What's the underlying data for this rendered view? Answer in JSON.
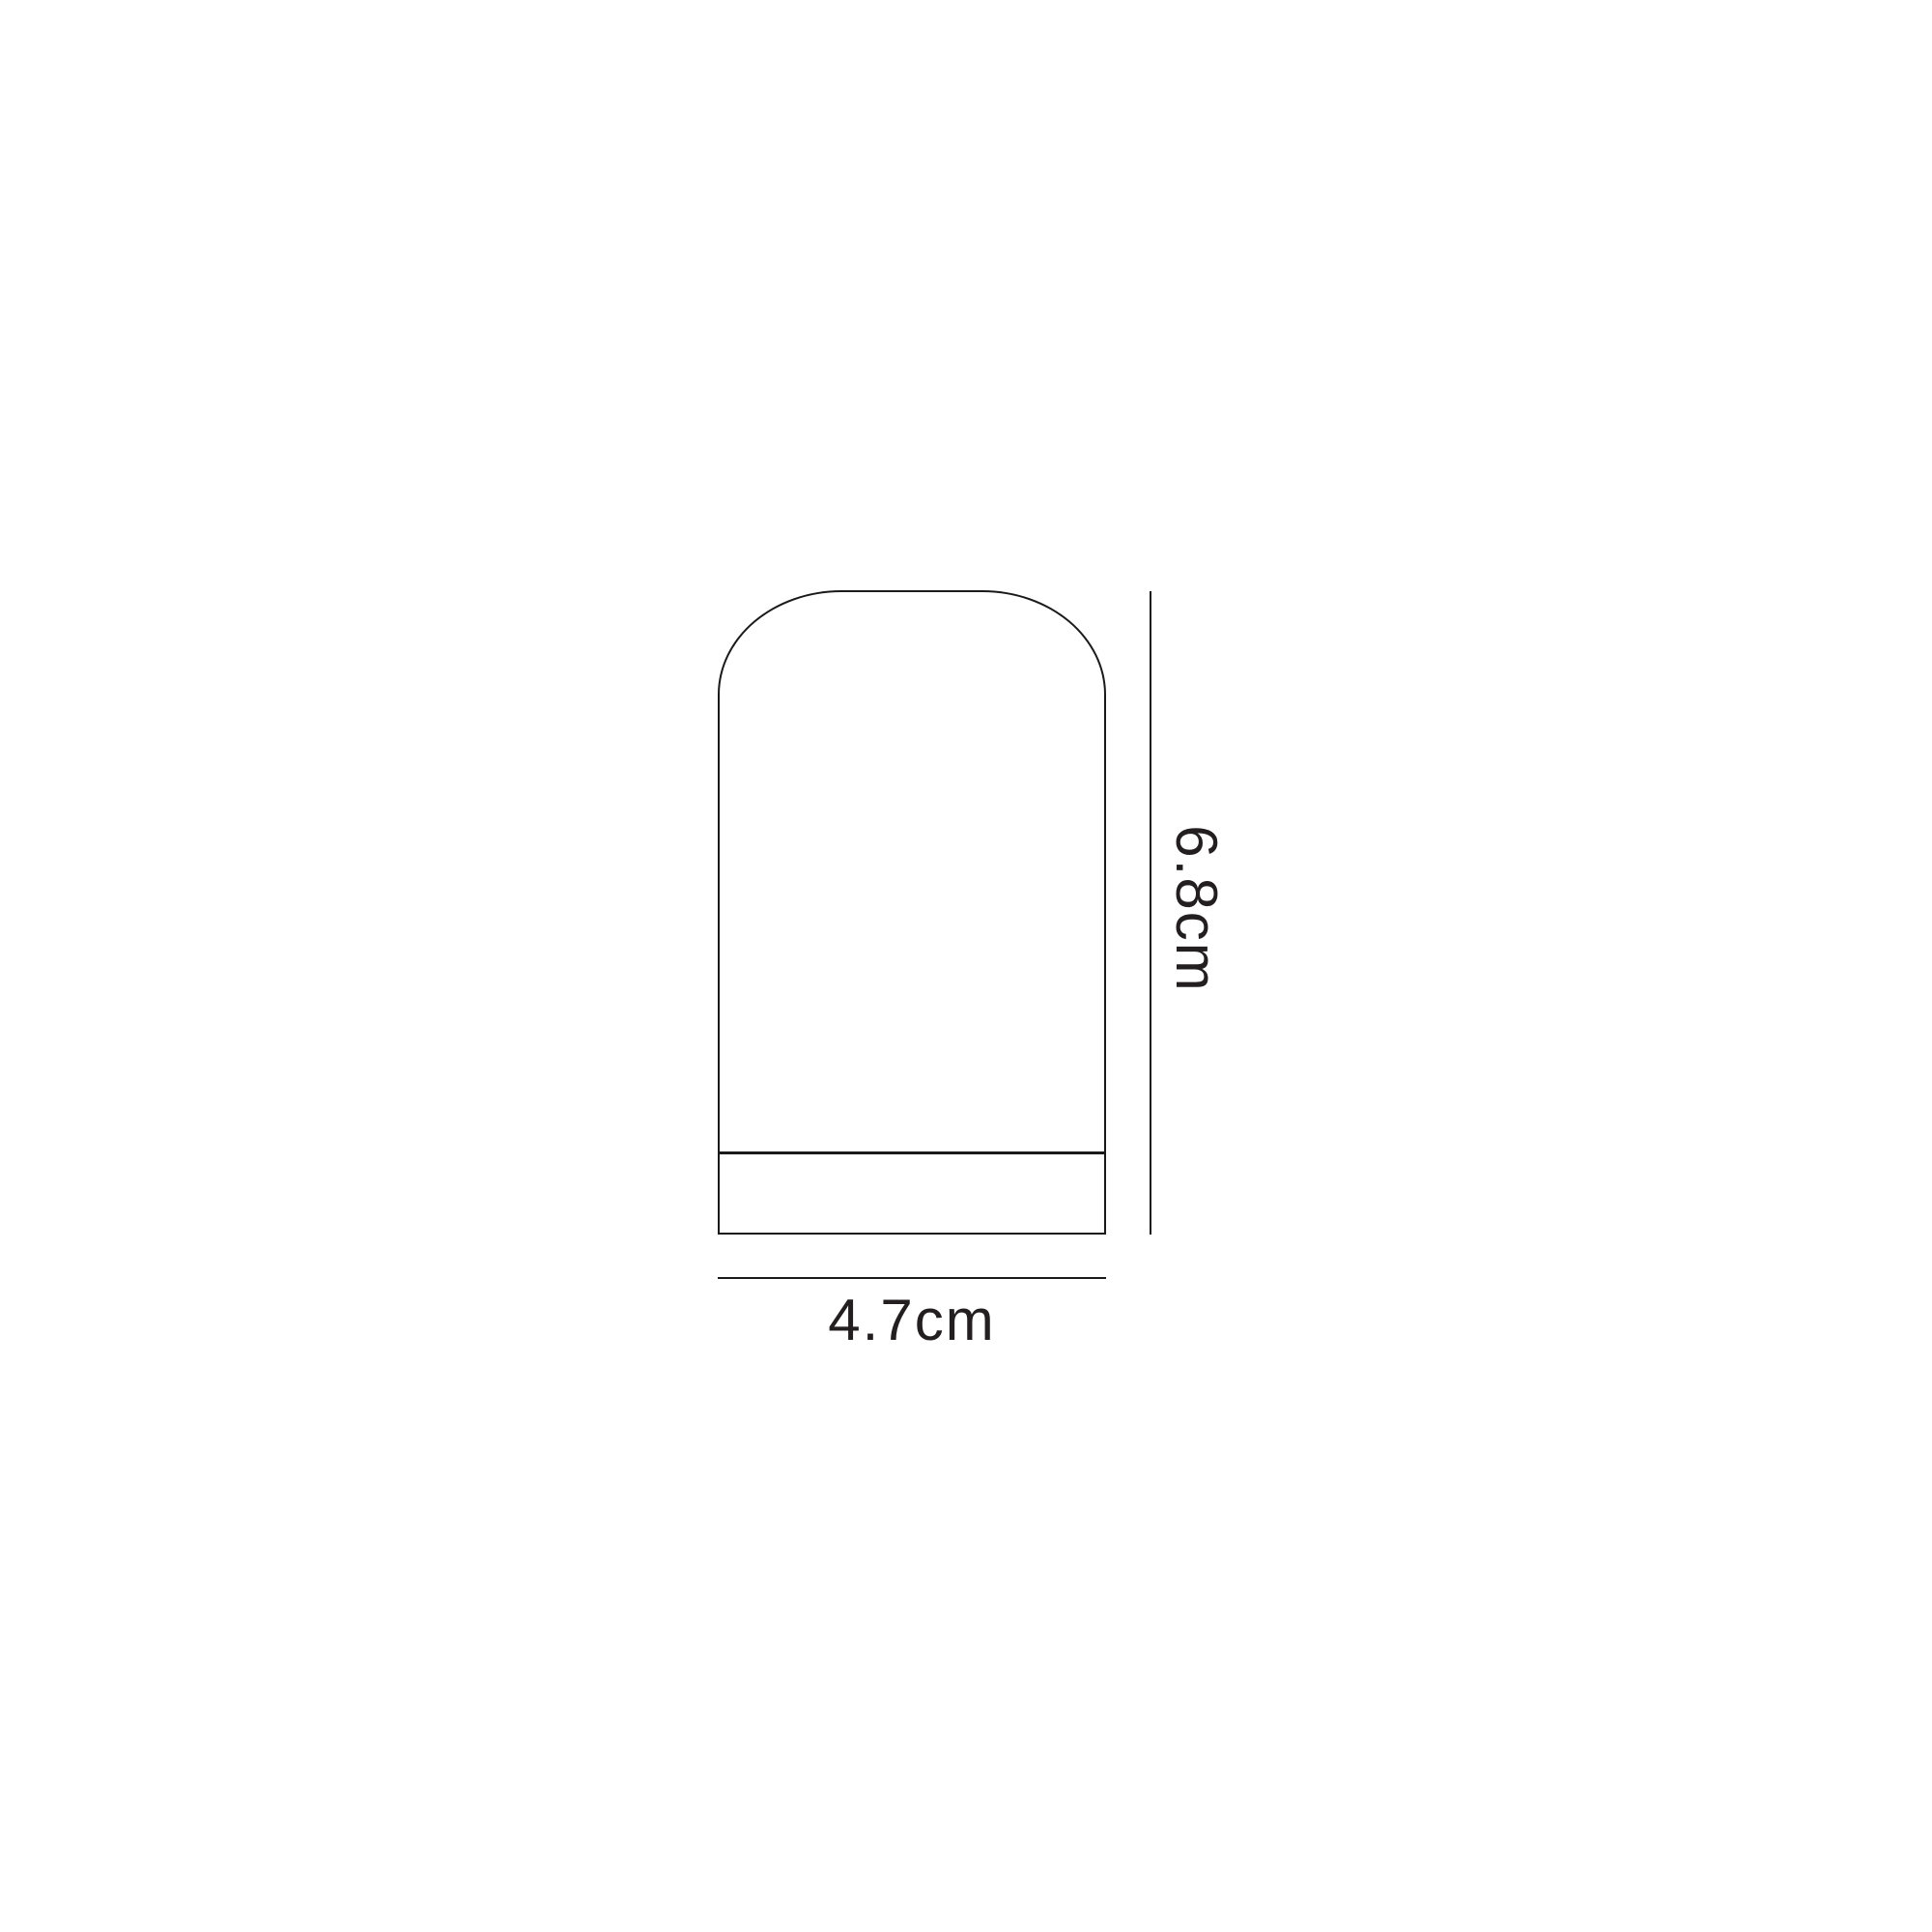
{
  "canvas": {
    "background_color": "#ffffff",
    "stroke_color": "#1a1a1a",
    "text_color": "#231f20"
  },
  "diagram": {
    "shape_name": "arched-top shade outline with base band",
    "height_label": "6.8cm",
    "width_label": "4.7cm"
  }
}
